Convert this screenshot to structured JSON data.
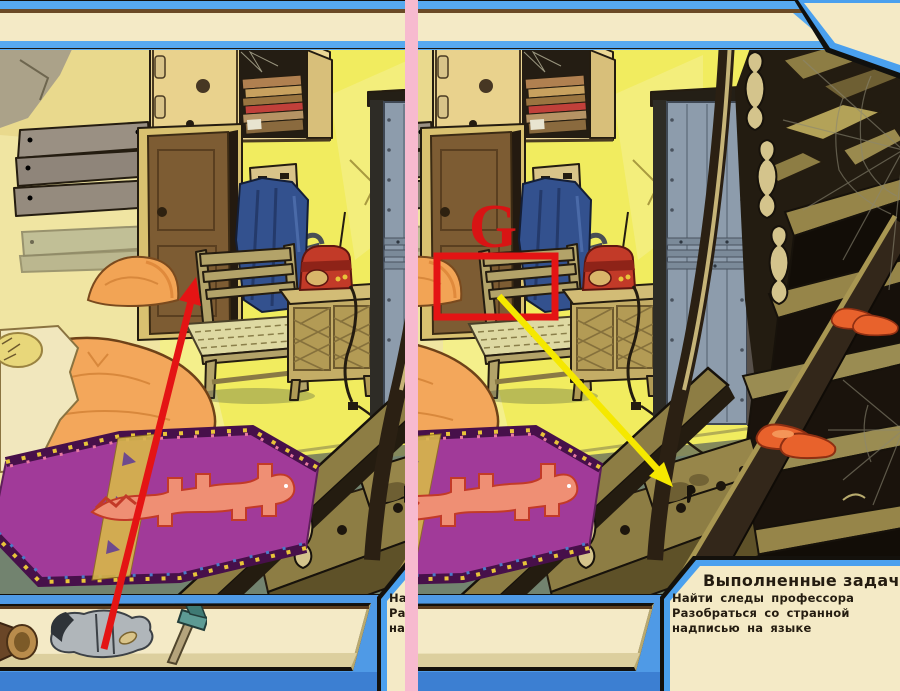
{
  "window": {
    "width": 900,
    "height": 691
  },
  "comparison": {
    "divider_color": "#f7bacf",
    "left_panel_role": "screenshot crop A (with inventory items and red arrow hint)",
    "right_panel_role": "screenshot crop B (with hidden letter G, red box and yellow arrow hint)"
  },
  "colors": {
    "ui_blue": "#57a9ef",
    "ui_blue_dark": "#3c7fd2",
    "panel_cream": "#f4eac6",
    "panel_border_blue": "#4aa0ee",
    "panel_border_black": "#14110c",
    "wall_yellow": "#f1ec5f",
    "side_wall_tan": "#e9d98d",
    "rug_purple": "#a13a99",
    "rug_lizard_salmon": "#ef8f74",
    "wood_olive": "#968549",
    "wood_dark": "#33271a",
    "radio_red": "#c23a28",
    "metal_door_gray": "#8d9cac",
    "blanket_orange": "#f3a75b",
    "floor_teal": "#72836f",
    "slipper_orange": "#e8622c",
    "cloth_navy": "#33518e"
  },
  "game_ui": {
    "task_panel": {
      "title": "Выполненные задачи 0/2",
      "tasks": [
        "Найти следы профессора",
        "Разобраться со странной надписью на языке"
      ]
    },
    "inventory": {
      "items": [
        {
          "icon": "horn-icon",
          "label": "brass horn"
        },
        {
          "icon": "boots-icon",
          "label": "boots with trousers"
        },
        {
          "icon": "hammer-icon",
          "label": "hammer"
        }
      ]
    }
  },
  "annotations": {
    "left_panel": {
      "marker": "red-arrow",
      "color": "#e41414",
      "from": [
        104,
        649
      ],
      "to": [
        196,
        277
      ],
      "meaning": "points from inventory boots to the chair"
    },
    "right_panel": {
      "letter": "G",
      "letter_color": "#d81414",
      "box_color": "#e41414",
      "box": [
        437,
        256,
        118,
        61
      ],
      "arrow": {
        "color": "#f5e800",
        "from": [
          499,
          296
        ],
        "to": [
          673,
          487
        ]
      },
      "meaning": "hidden letter G above chair seat; arrow points to footprint on stair"
    }
  }
}
